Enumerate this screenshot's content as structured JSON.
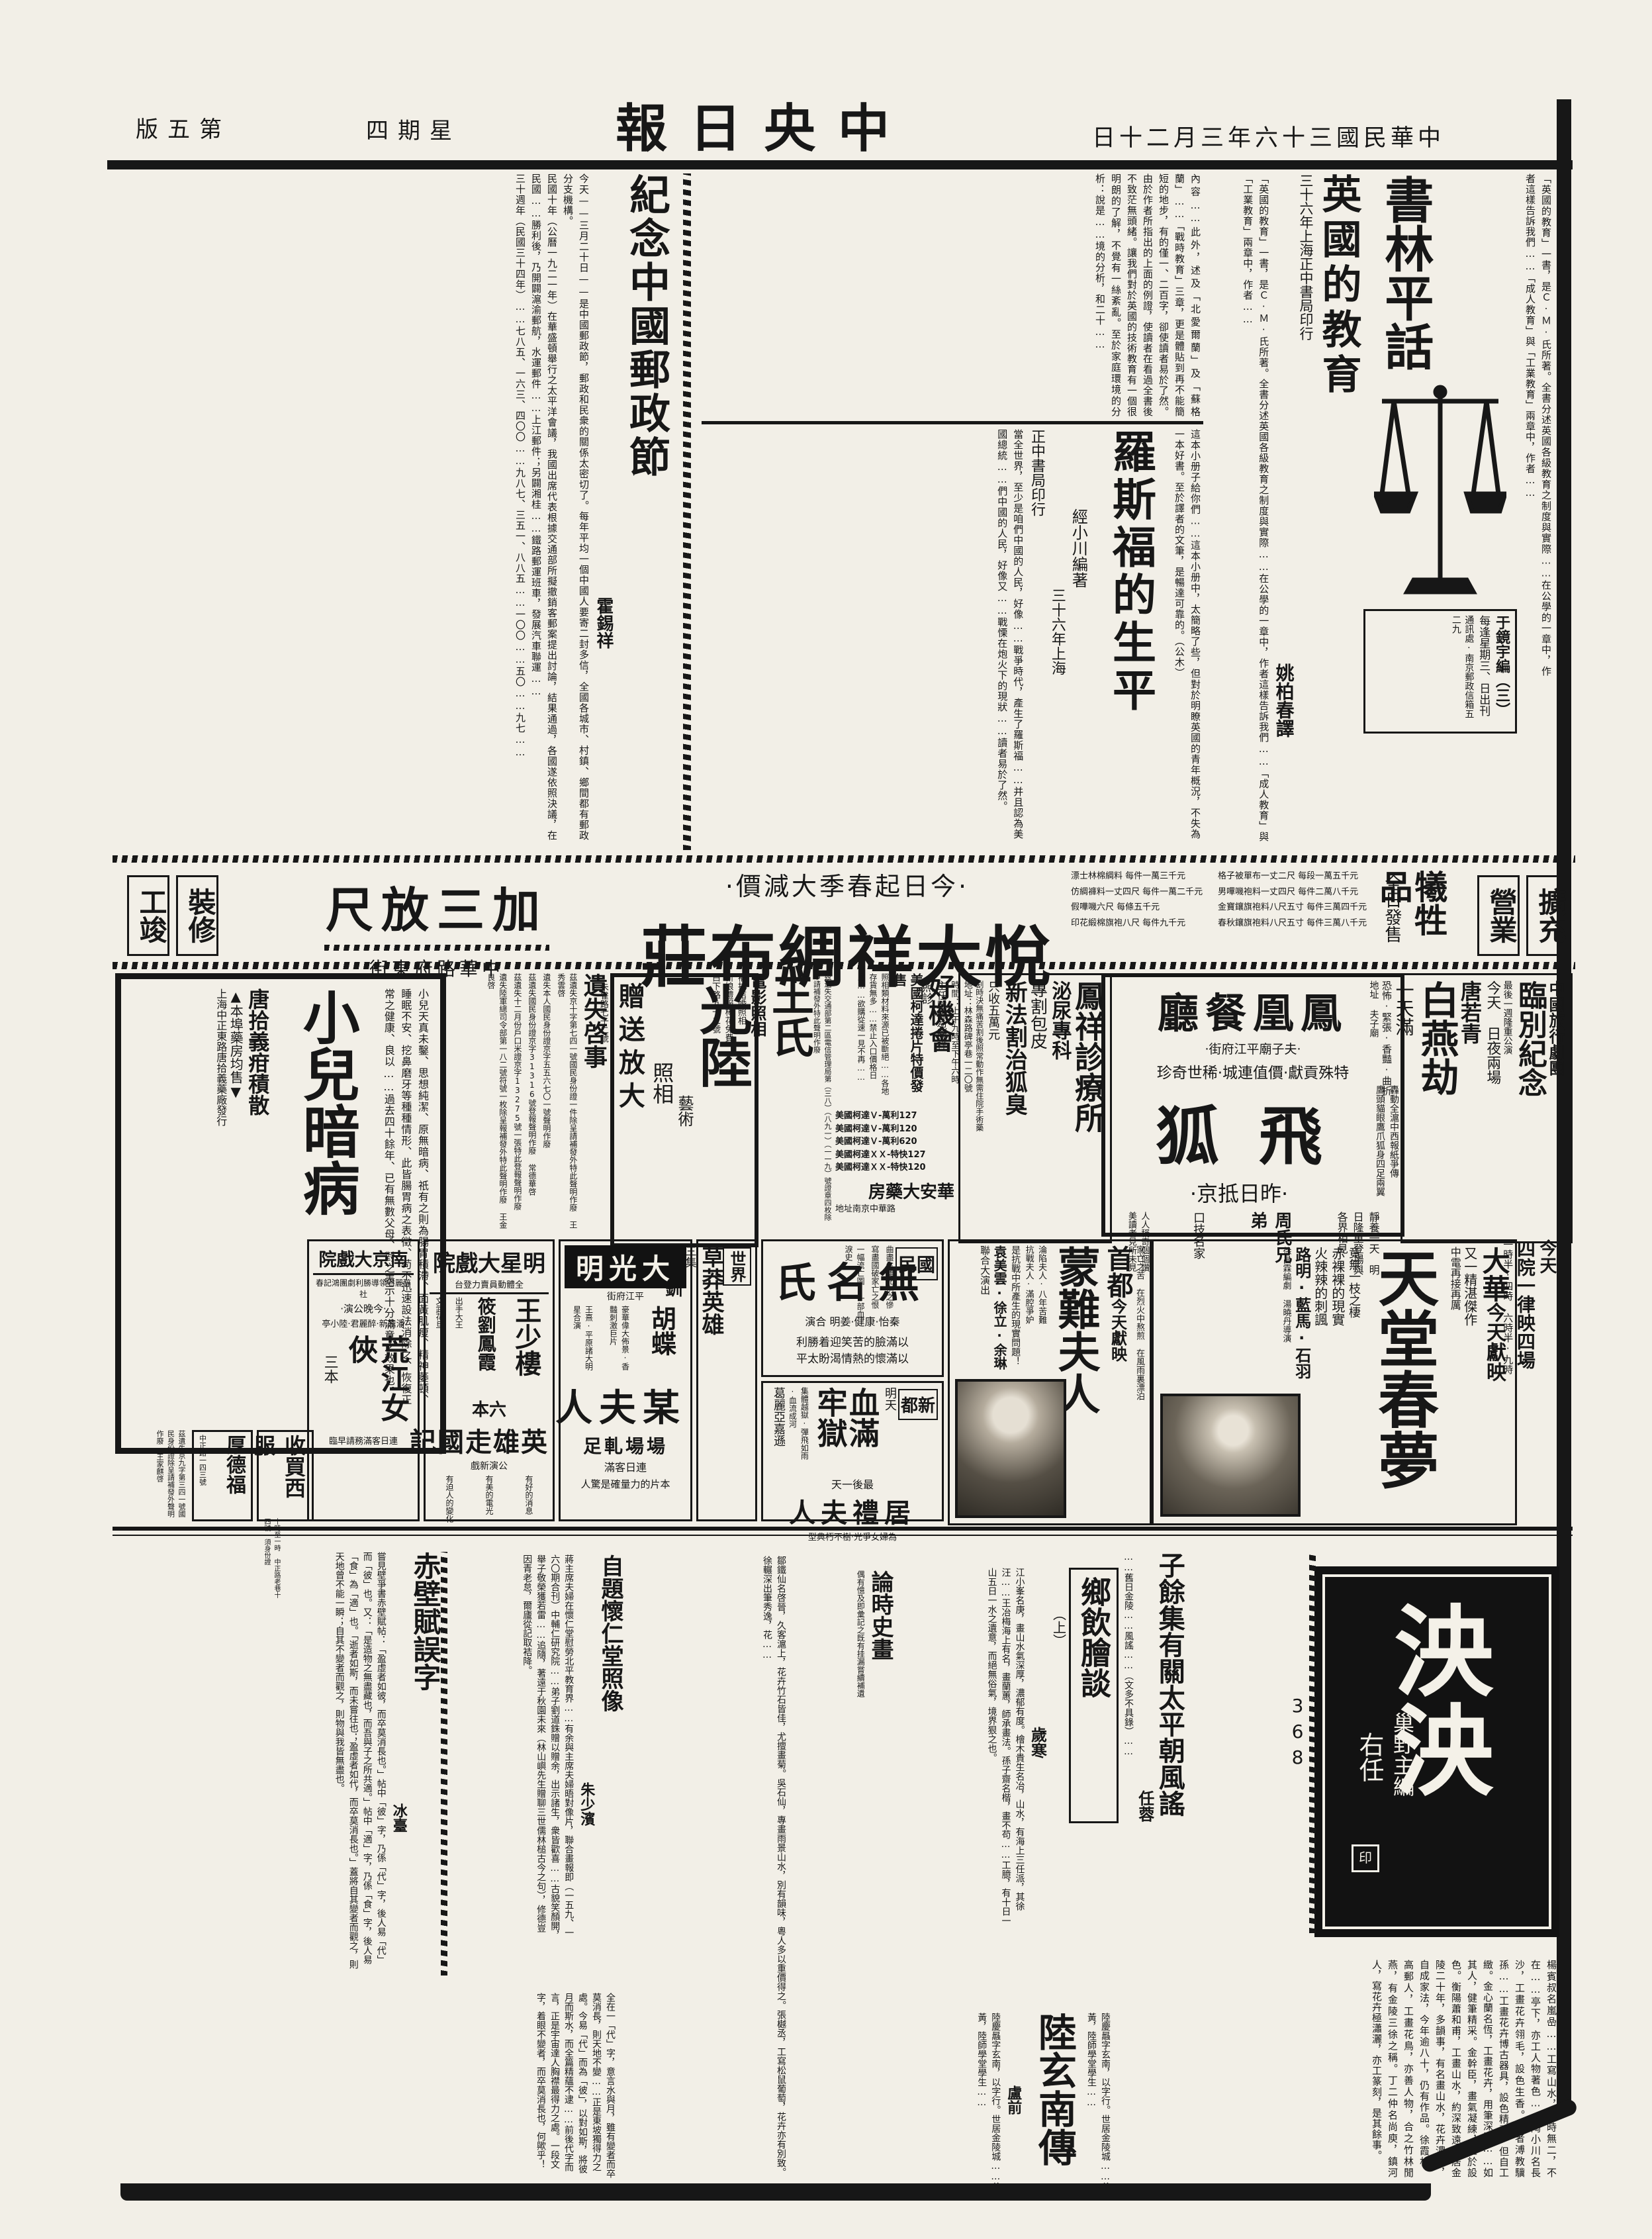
{
  "header": {
    "paper": "中央日報",
    "date": "中華民國三十六年三月二十日",
    "weekday": "星期四",
    "edition": "第五版"
  },
  "booktalk": {
    "title": "書林平話",
    "icon": "scales-of-justice",
    "box_editor": "于鏡宇編（三）",
    "box_sched": "每逢星期三、日出刊",
    "box_addr": "通訊處·南京郵政信箱五二九"
  },
  "uk": {
    "headline": "英國的教育",
    "pub": "三十六年上海正中書局印行",
    "byline": "姚柏春譯",
    "lead": "「英國的教育」一書，是Ｃ·Ｍ·氏所著。全書分述英國各級教育之制度與實際……在公學的一章中，作者這樣告訴我們……「成人教育」與「工業教育」兩章中，作者……",
    "body": "內容……此外，述及「北愛爾蘭」及「蘇格蘭」……「戰時教育」三章，更是體貼到再不能簡短的地步，有的僅一、二百字，卻使讀者易於了然。由於作者所指出的上面的例證，使讀者在看過全書後不致茫無頭緒。讓我們對於英國的技術教育有一個很明朗的了解，不覺有一絲紊亂。至於家庭環境的分析：說是……境的分析，和二十……"
  },
  "roosevelt": {
    "headline": "羅斯福的生平",
    "byline": "經小川編著",
    "pub1": "三十六年上海",
    "pub2": "正中書局印行",
    "lead": "這本小册子給你們……這本小册中，太簡略了些，但對於明瞭英國的青年概況，不失為一本好書。至於譯者的文筆，是暢達可靠的。（公木）",
    "body": "當全世界，至少是咱們中國的人民，好像……戰爭時代，產生了羅斯福……并且認為美國總統……們中國的人民，好像又……戰慄在炮火下的現狀……讀者易於了然。"
  },
  "postal": {
    "headline": "紀念中國郵政節",
    "byline": "霍錫祥",
    "lead": "今天——三月二十日——是中國郵政節，郵政和民衆的關係太密切了。每年平均一個中國人要寄二封多信，全國各城市、村鎮、鄉間都有郵政分支機構。",
    "body": "民國十年（公曆一九二一年）在華盛頓舉行之太平洋會議，我國出席代表根據交通部所擬撤銷客郵案提出討論，結果通過，各國遂依照決議，在民國……勝利後，乃開闢滬渝郵航，水運郵件……上江郵件；另闢湘桂……鐵路郵運班車，發展汽車聯運……",
    "stats": "三十週年（民國三十四年）……七八五、一六三、四〇〇……九八七、三五一、八八五……一〇〇……五〇……九七……"
  },
  "banner": {
    "right_box1": "擴充",
    "right_box2": "營業",
    "sac": "犧牲品",
    "sac_sub": "全日發售",
    "prices_a": [
      "格子被單布一丈二尺 每段一萬五千元",
      "男嗶嘰袍料一丈四尺 每件二萬八千元",
      "金寶鑲旗袍料八尺五寸 每件三萬四千元",
      "春秋鑲旗袍料八尺五寸 每件三萬八千元"
    ],
    "prices_b": [
      "漂士林棉綢料 每件一萬三千元",
      "仿綢褲料一丈四尺 每件一萬二千元",
      "假嘩嘰六尺 每條五千元",
      "印花緞棉旗袍八尺 每件九千元"
    ],
    "promo": "·今日起春季大減價·",
    "store": "悅大祥綢布莊",
    "deal": "加三放尺",
    "addr": "中華路府東街",
    "left_box1": "裝修",
    "left_box2": "工竣"
  },
  "troupe": {
    "org": "中國旅行劇團",
    "title": "臨別紀念",
    "note": "最後一週隆重公演",
    "when": "今天 日夜兩場",
    "time": "二時半·八時",
    "star": "唐若青",
    "play": "白燕劫",
    "full": "一天滿",
    "tags": "恐怖·緊張·香豔·曲折",
    "addr": "地址 夫子廟"
  },
  "phoenix": {
    "name": "鳳凰餐廳",
    "addr": "·夫子廟平江府街·",
    "slogan": "特殊貢獻·價值連城·稀世奇珍",
    "act": "飛狐",
    "arrive": "·昨日抵京·",
    "hype1": "轟動全滬中西報紙爭傳",
    "hype2": "鷹頭貓眼鷹爪狐身四足兩翼",
    "rest": "靜養一天",
    "debut": "明日隆重登場與各界相見",
    "bros": "周氏兄弟",
    "skill": "口技名家",
    "praise": "人人稱奇個個讚美讀者見所未見"
  },
  "clinic": {
    "name": "鳳祥診療所",
    "dept": "泌尿專科",
    "cut": "專割包皮",
    "newtreat": "新法割治狐臭",
    "price": "只收五萬元",
    "note": "割時決無痛苦割後照常動作無需住院手術藥",
    "addr": "地址：林森路碑亭巷一二〇號",
    "time": "時間：上午九時至下午六時",
    "doc": "主任醫師苑鳳祥",
    "visit": "照診"
  },
  "kodak": {
    "title": "好機會",
    "sub": "美國柯達捲片特價發售",
    "body": "照相類材料來源已被斷絕……各地存貨無多……禁止入口價格日昂……欲購從速一見不再……",
    "items": [
      "美國柯達Ｖ-萬利127",
      "美國柯達Ｖ-萬利120",
      "美國柯達Ｖ-萬利620",
      "美國柯達ＸＸ-特快127",
      "美國柯達ＸＸ-特快120"
    ],
    "store": "華安大藥房",
    "addr": "地址南京中華路"
  },
  "wang": {
    "name": "王氏",
    "svc": "電影照相",
    "l1": "補拍結婚照相",
    "l2": "新娘禮服棒花免費",
    "addr": "白下路九十二號",
    "notice": "茲遺失交通部第二區電信管理局第（三八）（八九一）（一一九）號證章四枚除申請補發外特此聲明作廢"
  },
  "guanglu": {
    "name": "光陸",
    "art": "藝術",
    "photo": "照相",
    "gift": "贈送放大",
    "addr": "朱雀路七十二號"
  },
  "lost": {
    "title": "遺失啓事",
    "n1": "茲遺失京十字第七四一號國民身份證一件除呈請補發外特此聲明作廢 王秀雲啓",
    "n2": "遺失本人國民身份證京字五五六七〇一號聲明作廢",
    "n3": "茲遺失國民身份證京字31316號登報聲明作廢 常德華啓",
    "n4": "茲遺失十二月份戶口米證京字13275號一張特此登報聲明作廢",
    "n5": "遺失陸軍總司令部第一八二號符號一枚除呈報補發外特此聲明作廢 王金良啓"
  },
  "child": {
    "title": "小兒暗病",
    "body": "小兒天真未鑿、思想純潔、原無暗病、祇有之則為腸胃積滯、面黃肌瘦、精神萎頓、睡眠不安、挖鼻磨牙等種種情形、此皆腸胃病之表徵、苟不迅速設法消除之、恢復正常之健康、良以……過去四十餘年、已有無數父母、對之表示十分滿意之效果也。",
    "med": "唐拾義疳積散",
    "note": "▲本埠藥房均售▼",
    "maker": "上海中正東路唐拾義藥廠發行"
  },
  "sched": {
    "line1": "今天",
    "line2": "四院一律映四場",
    "times": "一時半·四時 六時半·九時"
  },
  "dahua": {
    "name": "大華",
    "now": "今天獻映",
    "film": "天堂春夢",
    "tag": "又一精湛傑作",
    "tag2": "中電再接再厲",
    "l1": "竟無一枝之棲",
    "l2": "赤裸裸的現實",
    "l3": "火辣辣的刺諷",
    "cast": "路明·藍馬·石羽",
    "crew": "徐昌霖編劇 湯曉丹導演"
  },
  "shoudu": {
    "name": "首都",
    "now": "今天獻映",
    "film": "蒙難夫人",
    "t1": "淪陷夫人·八年苦難",
    "t2": "抗戰夫人·滿腔爭妒",
    "q": "是抗戰中所產生的現實問題！",
    "cast": "袁美雲·徐立·余琳",
    "co": "聯合大演出",
    "side1": "家亡之苦",
    "side2": "在烈火中熬煎",
    "side3": "在風雨裏漂泊"
  },
  "guomin": {
    "name": "國民",
    "film": "無名氏",
    "cast": "秦怡·康健·姜明 合演",
    "l1": "曲盡生離死別之慘",
    "l2": "寫盡國破家亡之恨",
    "l3": "一幅流亡圖·一部血淚史",
    "s1": "以滿臉的苦笑迎着勝利",
    "s2": "以滿懷的熱情渴盼太平"
  },
  "xindu": {
    "name": "新都",
    "tomorrow": "明天",
    "film": "血滿牢獄",
    "tags": "集體越獄·彈飛如雨·血流成河",
    "star": "葛麗亞嘉遜",
    "last": "最後一天",
    "film2": "居禮夫人",
    "praise": "為婦女爭光·樹不朽典型"
  },
  "shijie": {
    "name": "世界",
    "film": "草莽英雄",
    "part": "三集",
    "film2": "王寶釧",
    "part2": "四集"
  },
  "dgm": {
    "name": "大光明",
    "addr": "平江府街",
    "star": "胡蝶",
    "film": "某夫人",
    "full": "場場軋足",
    "note": "連日客滿",
    "power": "本片的力量確是驚人",
    "cast": "王熹·平原諸大明星合演",
    "hype": "豪華偉大佈景·香豔刺激巨片"
  },
  "mingxing": {
    "name": "明星大戲院",
    "note": "全體動員賣力登台",
    "star1": "王少樓",
    "star2": "筱劉鳳霞",
    "r1": "出手大王",
    "r2": "文武花旦",
    "vol": "六本",
    "film": "英雄走國記",
    "newshow": "公演新戲",
    "b1": "有好的消息",
    "b2": "有美的電光",
    "b3": "有迫人的變化"
  },
  "nanjing": {
    "name": "南京大戲院",
    "troupe": "醉麗君領導勝利劇團鴻記春社",
    "tonight": "·今晚公演·",
    "cast": "潘鼎新·醉麗君·陸小亭",
    "film": "荒江女俠",
    "part": "三本",
    "note": "連日客滿務請早臨"
  },
  "houde": {
    "name": "厚德福",
    "addr": "中正路一四三號"
  },
  "west": {
    "name": "收買西服",
    "note": "十時至一時 中正路老巷十四號 須身份證"
  },
  "lostrow": {
    "n1": "茲遺失京九字第三四一號國民身份證除呈請補發外聲明作廢 王家麒啓"
  },
  "supp": {
    "mast": "泱泱",
    "editor": "巢野主編",
    "calli": "右任",
    "seal": "印",
    "issue": "368",
    "ziyu": {
      "headline": "子餘集有關太平朝風謠",
      "byline": "任蓉",
      "body": "……舊日金陵……風謠……（文多不具錄）……"
    },
    "painters": "楊賓叔名嵐喦……工寫山水，一時無二，不在……亭下，亦工人物著色……陶小川名長沙，工畫花卉翎毛，設色生香。清者溥教驥孫……工畫花卉博古器具，設色精麗，但自工緻。金心蘭名恆，工畫花卉，用筆深沈……如其人，健筆精采。金幹臣，畫氣凝練，工於設色。衡陽蕭和甫，工畫山水，約深致遠，居金陵二十年，多韻事，有名畫山水，花卉濃郁，自成家法，今年逾八十，仍有作品。徐霞村，高郵人，工畫花鳥，亦善人物，合之竹林閒燕，有金陵三徐之稱。丁二仲名尚庾，鎮河人，寫花卉極瀟灑，亦工篆刻，是其餘事。",
    "xiangyin": {
      "headline": "鄉飲膾談",
      "part": "（上）",
      "byline": "歲寒",
      "body": "江小峯名庚，畫山水氣深厚，濃郁有度。檜木貴生名冶，山水，有海上三任派，其徐汪……王冶梅海上有名，畫蘭蕙，師承畫法。孫子齋名楷，畫不苟……工臆，有十日一山五日一水之遺意，而絕無俗氣，境界狠之也。",
      "body2": "鄒鐵仙名啓晉，久客滬上，花卉竹石皆佳，尤擅畫菊。吳石仙，專畫雨景山水，別有韻味，粵人多以重價得之。張樾丞，工寫松鼠葡萄，花卉亦有別致。徐輾深出筆秀逸，花……"
    },
    "lunshi": {
      "headline": "論時史畫",
      "note": "偶有憶及即彙記之既有挂漏嘗續補遺"
    },
    "lu": {
      "headline": "陸玄南傳",
      "byline": "盧前",
      "body": "陸慶曧字玄南，以字行。世居金陵城……父秋黃，陸師學堂學生……"
    },
    "chibi": {
      "headline": "赤壁賦誤字",
      "byline": "冰臺",
      "body": "嘗見壁爭書赤壁賦帖：「盈虛者如彼，而卒莫消長也。」帖中「彼」字，乃係「代」字，後人易「代」而「彼」也。又：「是造物之無盡藏也，而吾與子之所共適。」帖中「適」字，乃係「食」字，後人易「食」為「適」也。「逝者如斯，而未嘗往也；盈虛者如代，而卒莫消長也。」蓋將自其變者而觀之，則天地曾不能一瞬；自其不變者而觀之，則物與我皆無盡也。",
      "body2": "全在一「代」字，意言水與月，雖有變者而卒莫消長，則天地不變……正是東坡獨得力之處。今易「代」而為「彼」，以對如斯，將彼月而斯水，而全篇精蘊不逮……前後代字而言，正是宇宙達人胸襟最得力之處。一段文字，着眼不變者，而卒莫消長也，何歟乎！"
    },
    "ziti": {
      "headline": "自題懷仁堂照像",
      "byline": "朱少濱",
      "body": "蔣主席夫婦在懷仁堂慰勞北平教育界……有余與主席夫婦晤對像片，聯合畫報即（一五九、一六〇期合刊）中輔仁研究院……弟子劉道銖贈以贈余，出示諸生，衆皆歡喜……古貌笑顏開，舉子敬榮獲若雷……追隨，著遠于秋園未來（林山嶼先生贈聊三世儒林槌古今之句），修德豈因青老怠，爾廬從記取袺降。"
    }
  }
}
